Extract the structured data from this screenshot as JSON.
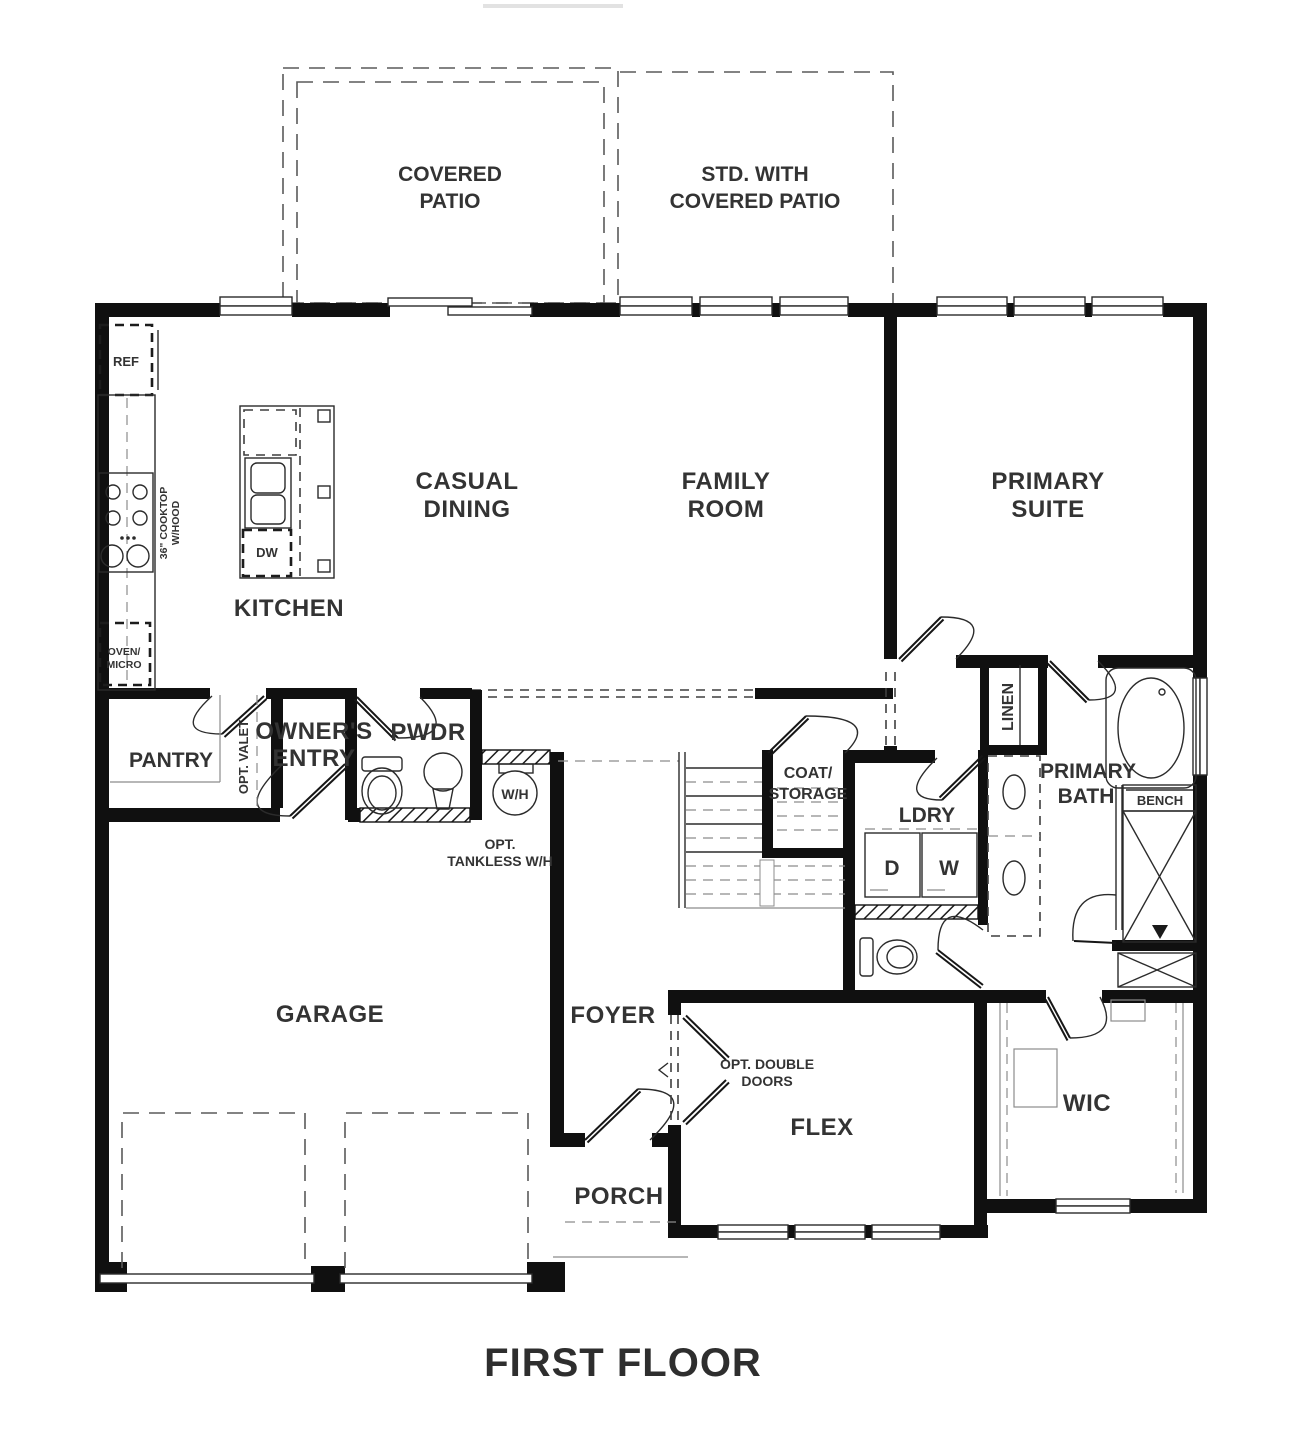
{
  "title": {
    "text": "FIRST FLOOR"
  },
  "colors": {
    "wall": "#101010",
    "label": "#333333",
    "light_line": "#8c8c8c"
  },
  "rooms": {
    "covered_patio": {
      "line1": "COVERED",
      "line2": "PATIO"
    },
    "std_patio": {
      "line1": "STD. WITH",
      "line2": "COVERED PATIO"
    },
    "casual_dining": {
      "line1": "CASUAL",
      "line2": "DINING"
    },
    "family_room": {
      "line1": "FAMILY",
      "line2": "ROOM"
    },
    "primary_suite": {
      "line1": "PRIMARY",
      "line2": "SUITE"
    },
    "kitchen": {
      "label": "KITCHEN"
    },
    "pantry": {
      "label": "PANTRY"
    },
    "owners_entry": {
      "line1": "OWNER'S",
      "line2": "ENTRY"
    },
    "pwdr": {
      "label": "PWDR"
    },
    "coat_storage": {
      "line1": "COAT/",
      "line2": "STORAGE"
    },
    "ldry": {
      "label": "LDRY"
    },
    "linen": {
      "label": "LINEN"
    },
    "primary_bath": {
      "line1": "PRIMARY",
      "line2": "BATH"
    },
    "garage": {
      "label": "GARAGE"
    },
    "foyer": {
      "label": "FOYER"
    },
    "porch": {
      "label": "PORCH"
    },
    "flex": {
      "label": "FLEX"
    },
    "wic": {
      "label": "WIC"
    }
  },
  "fixtures": {
    "ref": "REF",
    "cooktop_line1": "36\" COOKTOP",
    "cooktop_line2": "W/HOOD",
    "dw": "DW",
    "oven_micro_line1": "OVEN/",
    "oven_micro_line2": "MICRO",
    "wh": "W/H",
    "dryer": "D",
    "washer": "W",
    "bench": "BENCH"
  },
  "annotations": {
    "opt_valet": "OPT. VALET",
    "opt_tankless_line1": "OPT.",
    "opt_tankless_line2": "TANKLESS W/H",
    "opt_double_doors_line1": "OPT. DOUBLE",
    "opt_double_doors_line2": "DOORS"
  }
}
